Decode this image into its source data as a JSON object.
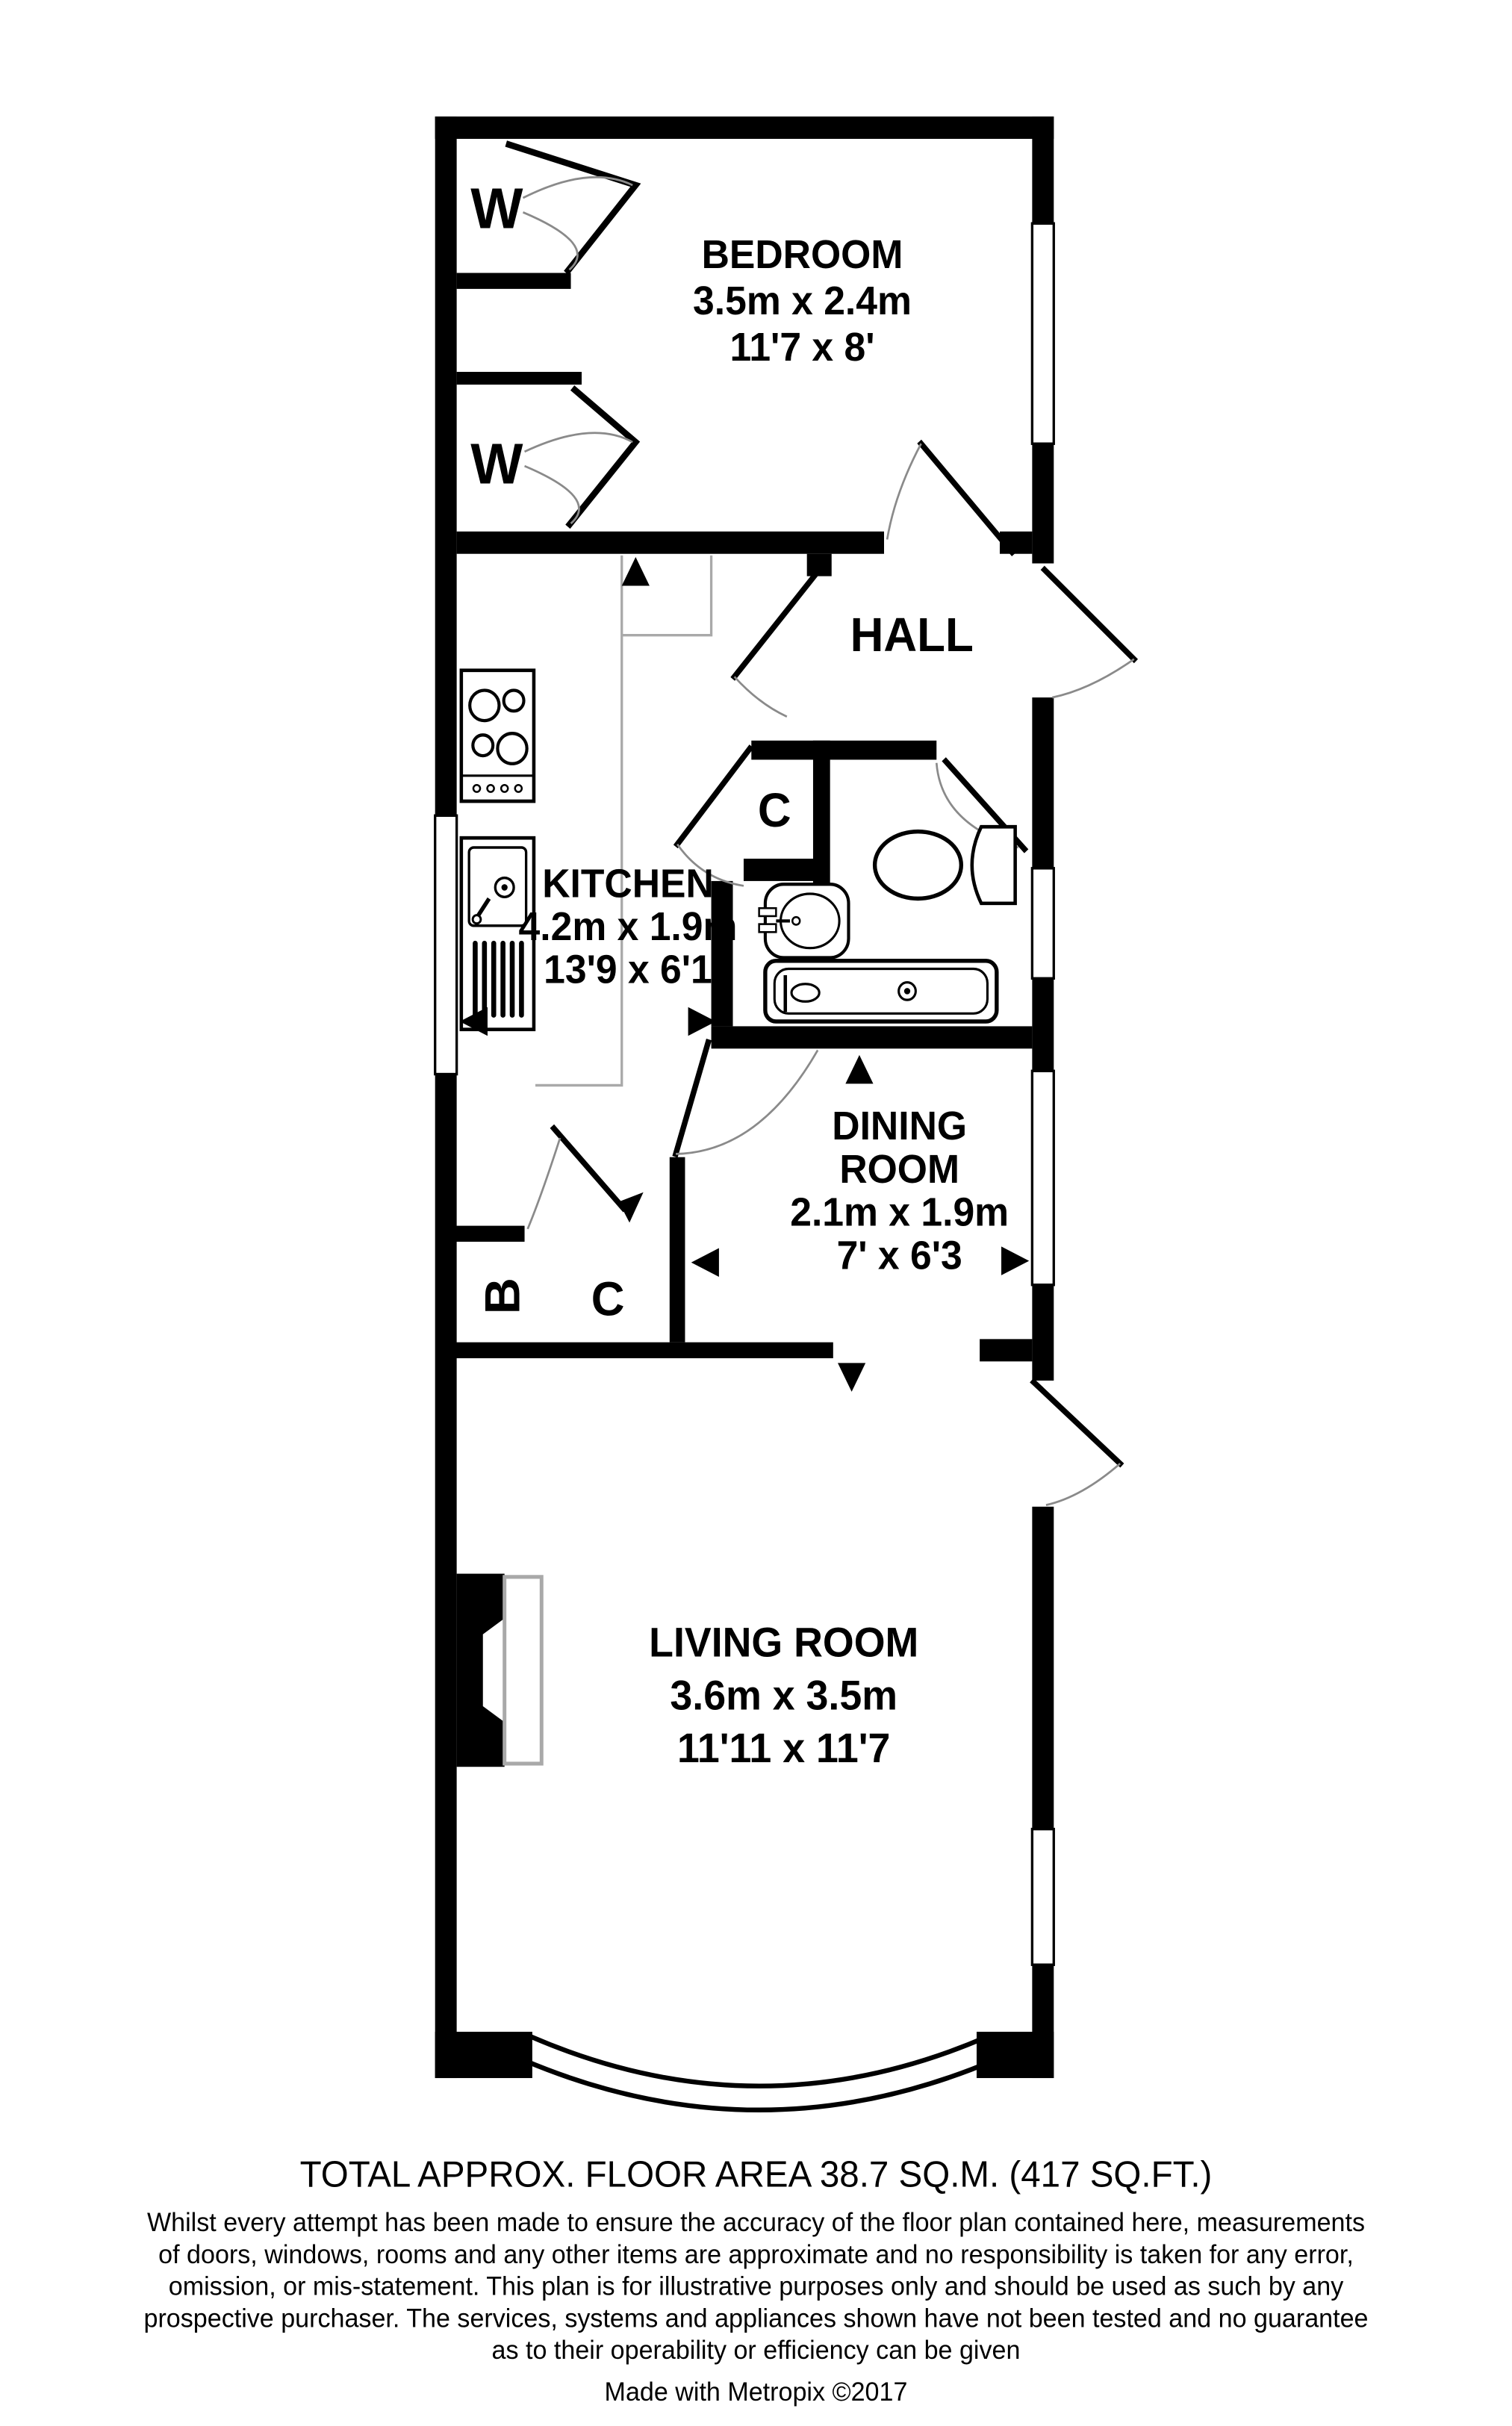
{
  "rooms": {
    "bedroom": {
      "name": "BEDROOM",
      "metric": "3.5m x 2.4m",
      "imperial": "11'7 x 8'"
    },
    "hall": {
      "name": "HALL"
    },
    "kitchen": {
      "name": "KITCHEN",
      "metric": "4.2m x 1.9m",
      "imperial": "13'9 x 6'1"
    },
    "dining": {
      "line1": "DINING",
      "line2": "ROOM",
      "metric": "2.1m x 1.9m",
      "imperial": "7' x 6'3"
    },
    "living": {
      "name": "LIVING ROOM",
      "metric": "3.6m x 3.5m",
      "imperial": "11'11 x 11'7"
    }
  },
  "labels": {
    "wardrobe": "W",
    "cupboard": "C",
    "boiler": "B"
  },
  "footer": {
    "total_area": "TOTAL APPROX. FLOOR AREA 38.7 SQ.M. (417 SQ.FT.)",
    "disclaimer_lines": [
      "Whilst every attempt has been made to ensure the accuracy of the floor plan contained here, measurements",
      "of doors, windows, rooms and any other items are approximate and no responsibility is taken for any error,",
      "omission, or mis-statement. This plan is for illustrative purposes only and should be used as such by any",
      "prospective purchaser. The services, systems and appliances shown have not been tested and no guarantee",
      "as to their operability or efficiency can be given"
    ],
    "credit": "Made with Metropix ©2017"
  },
  "colors": {
    "wall": "#000000",
    "door_arc": "#8a8a8a",
    "counter_edge": "#a9a9a9",
    "background": "#ffffff"
  }
}
